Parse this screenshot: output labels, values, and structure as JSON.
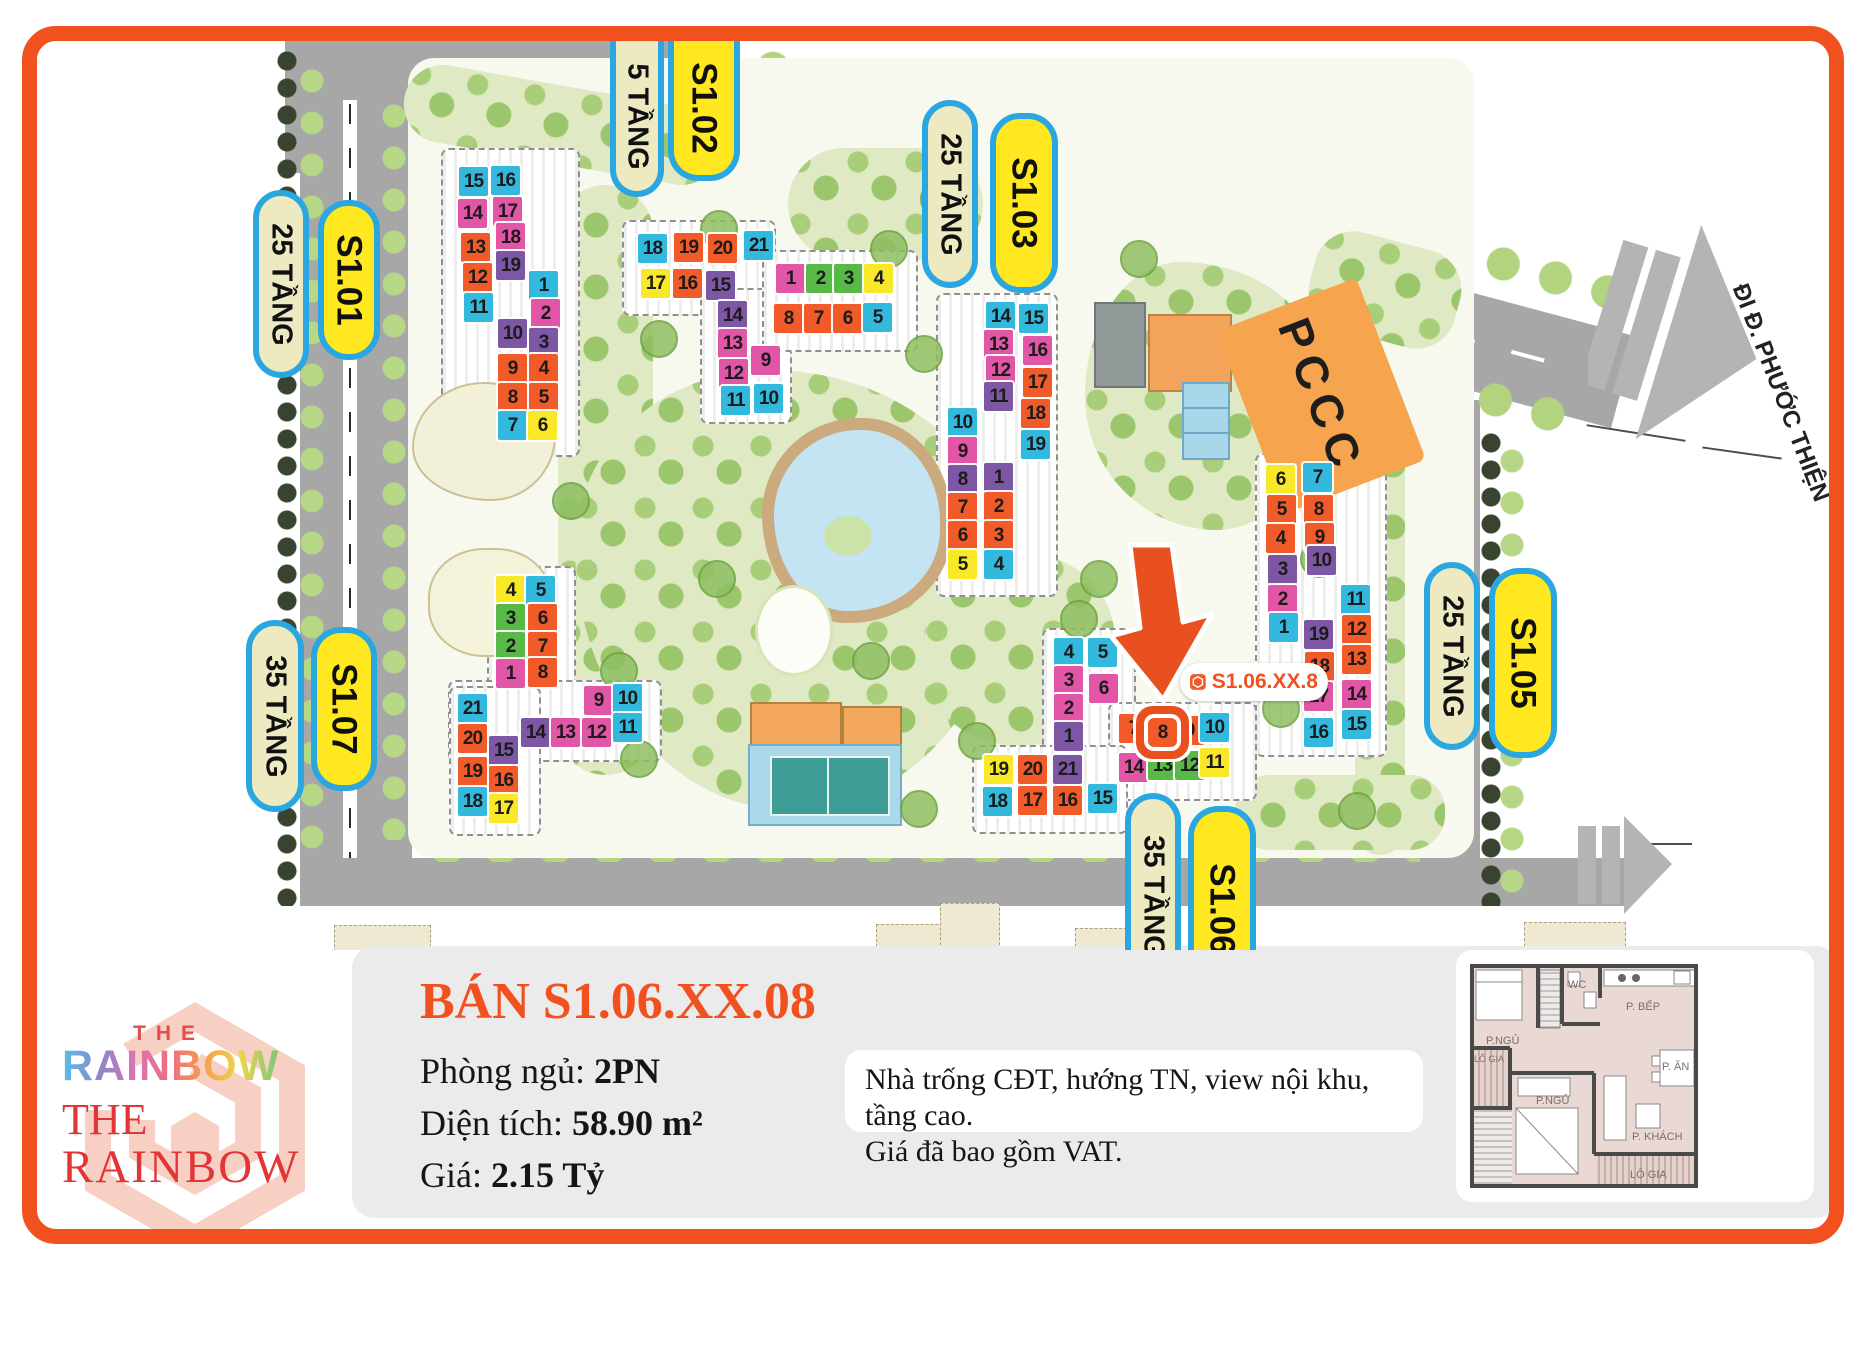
{
  "brand": {
    "the_top": "THE",
    "rainbow_top": "RAINBOW",
    "the_bottom": "THE",
    "rainbow_bottom": "RAINBOW"
  },
  "listing": {
    "title": "BÁN S1.06.XX.08",
    "fields": [
      {
        "label": "Phòng ngủ: ",
        "value": "2PN"
      },
      {
        "label": "Diện tích: ",
        "value": "58.90 m²"
      },
      {
        "label": "Giá: ",
        "value": "2.15 Tỷ"
      }
    ],
    "note": [
      "Nhà trống CĐT, hướng TN, view nội khu, tầng cao.",
      "Giá đã bao gồm VAT."
    ]
  },
  "floorplan": {
    "rooms": [
      "P.NGỦ",
      "WC",
      "P. BẾP",
      "LÔ GIA",
      "P.NGỦ",
      "P. ĂN",
      "P. KHÁCH",
      "LÔ GIA"
    ]
  },
  "map": {
    "direction_label": "ĐI Đ. PHƯỚC THIỆN",
    "pccc_label": "PCCC",
    "marker_label": "S1.06.XX.8",
    "pills": [
      {
        "text": "25 TẦNG",
        "type": "cream",
        "x": 253,
        "y": 190,
        "w": 56,
        "len": 188
      },
      {
        "text": "S1.01",
        "type": "yellow",
        "x": 318,
        "y": 200,
        "w": 62,
        "len": 160
      },
      {
        "text": "5 TẦNG",
        "type": "cream",
        "x": 610,
        "y": 41,
        "w": 54,
        "len": 156,
        "cut": "top"
      },
      {
        "text": "S1.02",
        "type": "yellow",
        "x": 668,
        "y": 41,
        "w": 72,
        "len": 140,
        "cut": "top"
      },
      {
        "text": "25 TẦNG",
        "type": "cream",
        "x": 922,
        "y": 100,
        "w": 56,
        "len": 188
      },
      {
        "text": "S1.03",
        "type": "yellow",
        "x": 990,
        "y": 113,
        "w": 68,
        "len": 180
      },
      {
        "text": "25 TẦNG",
        "type": "cream",
        "x": 1424,
        "y": 562,
        "w": 56,
        "len": 188
      },
      {
        "text": "S1.05",
        "type": "yellow",
        "x": 1489,
        "y": 568,
        "w": 68,
        "len": 190
      },
      {
        "text": "35 TẦNG",
        "type": "cream",
        "x": 246,
        "y": 620,
        "w": 58,
        "len": 192
      },
      {
        "text": "S1.07",
        "type": "yellow",
        "x": 311,
        "y": 627,
        "w": 66,
        "len": 164
      },
      {
        "text": "35 TẦNG",
        "type": "cream",
        "x": 1125,
        "y": 793,
        "w": 56,
        "len": 200,
        "cut": "bottom"
      },
      {
        "text": "S1.06",
        "type": "yellow",
        "x": 1188,
        "y": 806,
        "w": 68,
        "len": 200,
        "cut": "bottom"
      }
    ],
    "buildings": [
      {
        "id": "S1.01",
        "units": [
          {
            "n": 15,
            "c": "b",
            "x": 459,
            "y": 167
          },
          {
            "n": 16,
            "c": "b",
            "x": 491,
            "y": 166
          },
          {
            "n": 14,
            "c": "m",
            "x": 458,
            "y": 199
          },
          {
            "n": 17,
            "c": "m",
            "x": 493,
            "y": 197
          },
          {
            "n": 13,
            "c": "o",
            "x": 461,
            "y": 233
          },
          {
            "n": 18,
            "c": "m",
            "x": 496,
            "y": 223
          },
          {
            "n": 12,
            "c": "o",
            "x": 463,
            "y": 263
          },
          {
            "n": 19,
            "c": "p",
            "x": 496,
            "y": 251
          },
          {
            "n": 11,
            "c": "b",
            "x": 464,
            "y": 293
          },
          {
            "n": 1,
            "c": "b",
            "x": 529,
            "y": 271
          },
          {
            "n": 2,
            "c": "m",
            "x": 531,
            "y": 299
          },
          {
            "n": 10,
            "c": "p",
            "x": 498,
            "y": 319
          },
          {
            "n": 3,
            "c": "p",
            "x": 529,
            "y": 328
          },
          {
            "n": 9,
            "c": "o",
            "x": 498,
            "y": 354
          },
          {
            "n": 4,
            "c": "o",
            "x": 529,
            "y": 354
          },
          {
            "n": 8,
            "c": "o",
            "x": 498,
            "y": 383
          },
          {
            "n": 5,
            "c": "o",
            "x": 529,
            "y": 383
          },
          {
            "n": 7,
            "c": "b",
            "x": 498,
            "y": 411
          },
          {
            "n": 6,
            "c": "y",
            "x": 528,
            "y": 411
          }
        ]
      },
      {
        "id": "S1.02",
        "units": [
          {
            "n": 18,
            "c": "b",
            "x": 638,
            "y": 234
          },
          {
            "n": 19,
            "c": "o",
            "x": 674,
            "y": 233
          },
          {
            "n": 20,
            "c": "o",
            "x": 708,
            "y": 234
          },
          {
            "n": 21,
            "c": "b",
            "x": 744,
            "y": 231
          },
          {
            "n": 17,
            "c": "y",
            "x": 641,
            "y": 269
          },
          {
            "n": 16,
            "c": "o",
            "x": 673,
            "y": 269
          },
          {
            "n": 15,
            "c": "p",
            "x": 706,
            "y": 271
          },
          {
            "n": 14,
            "c": "p",
            "x": 718,
            "y": 301
          },
          {
            "n": 13,
            "c": "m",
            "x": 718,
            "y": 329
          },
          {
            "n": 12,
            "c": "m",
            "x": 719,
            "y": 359
          },
          {
            "n": 11,
            "c": "b",
            "x": 721,
            "y": 386
          },
          {
            "n": 9,
            "c": "m",
            "x": 751,
            "y": 346
          },
          {
            "n": 10,
            "c": "b",
            "x": 754,
            "y": 384
          },
          {
            "n": 1,
            "c": "m",
            "x": 776,
            "y": 264
          },
          {
            "n": 2,
            "c": "g",
            "x": 806,
            "y": 264
          },
          {
            "n": 3,
            "c": "g",
            "x": 834,
            "y": 264
          },
          {
            "n": 4,
            "c": "y",
            "x": 864,
            "y": 264
          },
          {
            "n": 8,
            "c": "o",
            "x": 774,
            "y": 304
          },
          {
            "n": 7,
            "c": "o",
            "x": 804,
            "y": 304
          },
          {
            "n": 6,
            "c": "o",
            "x": 833,
            "y": 304
          },
          {
            "n": 5,
            "c": "b",
            "x": 863,
            "y": 303
          }
        ]
      },
      {
        "id": "S1.03",
        "units": [
          {
            "n": 14,
            "c": "b",
            "x": 986,
            "y": 302
          },
          {
            "n": 15,
            "c": "b",
            "x": 1019,
            "y": 304
          },
          {
            "n": 13,
            "c": "m",
            "x": 984,
            "y": 330
          },
          {
            "n": 16,
            "c": "m",
            "x": 1023,
            "y": 336
          },
          {
            "n": 12,
            "c": "m",
            "x": 986,
            "y": 356
          },
          {
            "n": 17,
            "c": "o",
            "x": 1023,
            "y": 368
          },
          {
            "n": 11,
            "c": "p",
            "x": 984,
            "y": 382
          },
          {
            "n": 18,
            "c": "o",
            "x": 1021,
            "y": 399
          },
          {
            "n": 19,
            "c": "b",
            "x": 1021,
            "y": 430
          },
          {
            "n": 10,
            "c": "b",
            "x": 948,
            "y": 408
          },
          {
            "n": 9,
            "c": "m",
            "x": 948,
            "y": 437
          },
          {
            "n": 8,
            "c": "p",
            "x": 948,
            "y": 465
          },
          {
            "n": 1,
            "c": "p",
            "x": 984,
            "y": 463
          },
          {
            "n": 7,
            "c": "o",
            "x": 948,
            "y": 493
          },
          {
            "n": 2,
            "c": "o",
            "x": 984,
            "y": 492
          },
          {
            "n": 6,
            "c": "o",
            "x": 948,
            "y": 521
          },
          {
            "n": 3,
            "c": "o",
            "x": 984,
            "y": 521
          },
          {
            "n": 5,
            "c": "y",
            "x": 948,
            "y": 550
          },
          {
            "n": 4,
            "c": "b",
            "x": 984,
            "y": 550
          }
        ]
      },
      {
        "id": "S1.05",
        "units": [
          {
            "n": 6,
            "c": "y",
            "x": 1266,
            "y": 465
          },
          {
            "n": 7,
            "c": "b",
            "x": 1303,
            "y": 463
          },
          {
            "n": 5,
            "c": "o",
            "x": 1267,
            "y": 495
          },
          {
            "n": 8,
            "c": "o",
            "x": 1304,
            "y": 495
          },
          {
            "n": 4,
            "c": "o",
            "x": 1266,
            "y": 524
          },
          {
            "n": 9,
            "c": "o",
            "x": 1305,
            "y": 523
          },
          {
            "n": 3,
            "c": "p",
            "x": 1268,
            "y": 555
          },
          {
            "n": 10,
            "c": "p",
            "x": 1307,
            "y": 546
          },
          {
            "n": 2,
            "c": "m",
            "x": 1268,
            "y": 585
          },
          {
            "n": 11,
            "c": "b",
            "x": 1341,
            "y": 585
          },
          {
            "n": 1,
            "c": "b",
            "x": 1269,
            "y": 613
          },
          {
            "n": 19,
            "c": "p",
            "x": 1304,
            "y": 620
          },
          {
            "n": 12,
            "c": "o",
            "x": 1342,
            "y": 615
          },
          {
            "n": 18,
            "c": "o",
            "x": 1305,
            "y": 652
          },
          {
            "n": 13,
            "c": "o",
            "x": 1342,
            "y": 645
          },
          {
            "n": 17,
            "c": "m",
            "x": 1304,
            "y": 682
          },
          {
            "n": 14,
            "c": "m",
            "x": 1342,
            "y": 680
          },
          {
            "n": 16,
            "c": "b",
            "x": 1304,
            "y": 718
          },
          {
            "n": 15,
            "c": "b",
            "x": 1342,
            "y": 710
          }
        ]
      },
      {
        "id": "S1.06",
        "units": [
          {
            "n": 4,
            "c": "b",
            "x": 1054,
            "y": 638
          },
          {
            "n": 5,
            "c": "b",
            "x": 1088,
            "y": 638
          },
          {
            "n": 3,
            "c": "m",
            "x": 1054,
            "y": 666
          },
          {
            "n": 6,
            "c": "m",
            "x": 1089,
            "y": 674
          },
          {
            "n": 2,
            "c": "m",
            "x": 1054,
            "y": 694
          },
          {
            "n": 1,
            "c": "p",
            "x": 1054,
            "y": 722
          },
          {
            "n": 7,
            "c": "o",
            "x": 1119,
            "y": 714
          },
          {
            "n": 8,
            "c": "o",
            "x": 1148,
            "y": 718,
            "hl": 1
          },
          {
            "n": 9,
            "c": "o",
            "x": 1175,
            "y": 716
          },
          {
            "n": 10,
            "c": "b",
            "x": 1200,
            "y": 713
          },
          {
            "n": 14,
            "c": "m",
            "x": 1119,
            "y": 753
          },
          {
            "n": 13,
            "c": "g",
            "x": 1148,
            "y": 751
          },
          {
            "n": 12,
            "c": "g",
            "x": 1175,
            "y": 751
          },
          {
            "n": 11,
            "c": "y",
            "x": 1200,
            "y": 748
          },
          {
            "n": 19,
            "c": "y",
            "x": 984,
            "y": 755
          },
          {
            "n": 20,
            "c": "o",
            "x": 1018,
            "y": 755
          },
          {
            "n": 21,
            "c": "p",
            "x": 1053,
            "y": 755
          },
          {
            "n": 18,
            "c": "b",
            "x": 983,
            "y": 787
          },
          {
            "n": 17,
            "c": "o",
            "x": 1018,
            "y": 786
          },
          {
            "n": 16,
            "c": "o",
            "x": 1053,
            "y": 786
          },
          {
            "n": 15,
            "c": "b",
            "x": 1088,
            "y": 784
          }
        ]
      },
      {
        "id": "S1.07",
        "units": [
          {
            "n": 4,
            "c": "y",
            "x": 496,
            "y": 576
          },
          {
            "n": 5,
            "c": "b",
            "x": 526,
            "y": 576
          },
          {
            "n": 3,
            "c": "g",
            "x": 496,
            "y": 604
          },
          {
            "n": 6,
            "c": "o",
            "x": 528,
            "y": 604
          },
          {
            "n": 2,
            "c": "g",
            "x": 496,
            "y": 632
          },
          {
            "n": 7,
            "c": "o",
            "x": 528,
            "y": 632
          },
          {
            "n": 1,
            "c": "m",
            "x": 496,
            "y": 659
          },
          {
            "n": 8,
            "c": "o",
            "x": 528,
            "y": 658
          },
          {
            "n": 21,
            "c": "b",
            "x": 458,
            "y": 694
          },
          {
            "n": 9,
            "c": "m",
            "x": 584,
            "y": 686
          },
          {
            "n": 10,
            "c": "b",
            "x": 613,
            "y": 684
          },
          {
            "n": 20,
            "c": "o",
            "x": 458,
            "y": 724
          },
          {
            "n": 14,
            "c": "p",
            "x": 521,
            "y": 718
          },
          {
            "n": 13,
            "c": "m",
            "x": 551,
            "y": 718
          },
          {
            "n": 12,
            "c": "m",
            "x": 582,
            "y": 718
          },
          {
            "n": 11,
            "c": "b",
            "x": 613,
            "y": 713
          },
          {
            "n": 15,
            "c": "p",
            "x": 489,
            "y": 736
          },
          {
            "n": 19,
            "c": "o",
            "x": 458,
            "y": 757
          },
          {
            "n": 16,
            "c": "o",
            "x": 489,
            "y": 766
          },
          {
            "n": 18,
            "c": "b",
            "x": 458,
            "y": 787
          },
          {
            "n": 17,
            "c": "y",
            "x": 489,
            "y": 794
          }
        ]
      }
    ],
    "stubs": [
      [
        334,
        925,
        95,
        25
      ],
      [
        876,
        924,
        90,
        26
      ],
      [
        940,
        903,
        58,
        45
      ],
      [
        1075,
        928,
        50,
        22
      ],
      [
        1524,
        922,
        100,
        28
      ]
    ]
  },
  "colors": {
    "accent": "#F1511F",
    "tile_blue": "#33B9DD",
    "tile_magenta": "#E156A6",
    "tile_orange": "#F15A29",
    "tile_purple": "#7D57A4",
    "tile_yellow": "#F8E827",
    "tile_green": "#58B947",
    "pill_cream": "#EDE9C0",
    "pill_yellow": "#FFE81F",
    "pill_border": "#2AA6E0",
    "road_gray": "#A7A7A7",
    "pccc_orange": "#F6A54E"
  }
}
